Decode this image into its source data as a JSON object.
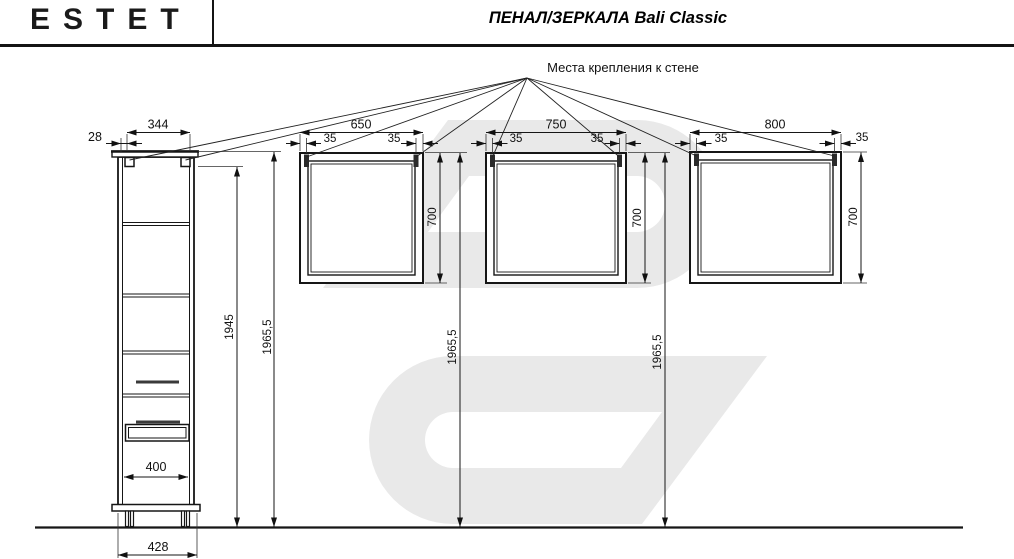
{
  "header": {
    "logo": "ESTET",
    "title": "ПЕНАЛ/ЗЕРКАЛА Bali Classic"
  },
  "drawing": {
    "mounting_label": "Места крепления к стене"
  },
  "cabinet": {
    "name": "пенал",
    "overhang": "28",
    "width_top": "344",
    "body_height": "1945",
    "total_height": "1965,5",
    "inner_width": "400",
    "base_width": "428"
  },
  "mirrors": [
    {
      "width": "650",
      "offset_left": "35",
      "offset_right": "35",
      "height": "700",
      "top_height": "1965,5"
    },
    {
      "width": "750",
      "offset_left": "35",
      "offset_right": "35",
      "height": "700",
      "top_height": "1965,5"
    },
    {
      "width": "800",
      "offset_left": "35",
      "offset_right": "35",
      "height": "700"
    }
  ],
  "colors": {
    "line": "#161616",
    "watermark": "#e9e9e9",
    "bracket": "#2b2b2b",
    "handle": "#3a3a3a"
  }
}
